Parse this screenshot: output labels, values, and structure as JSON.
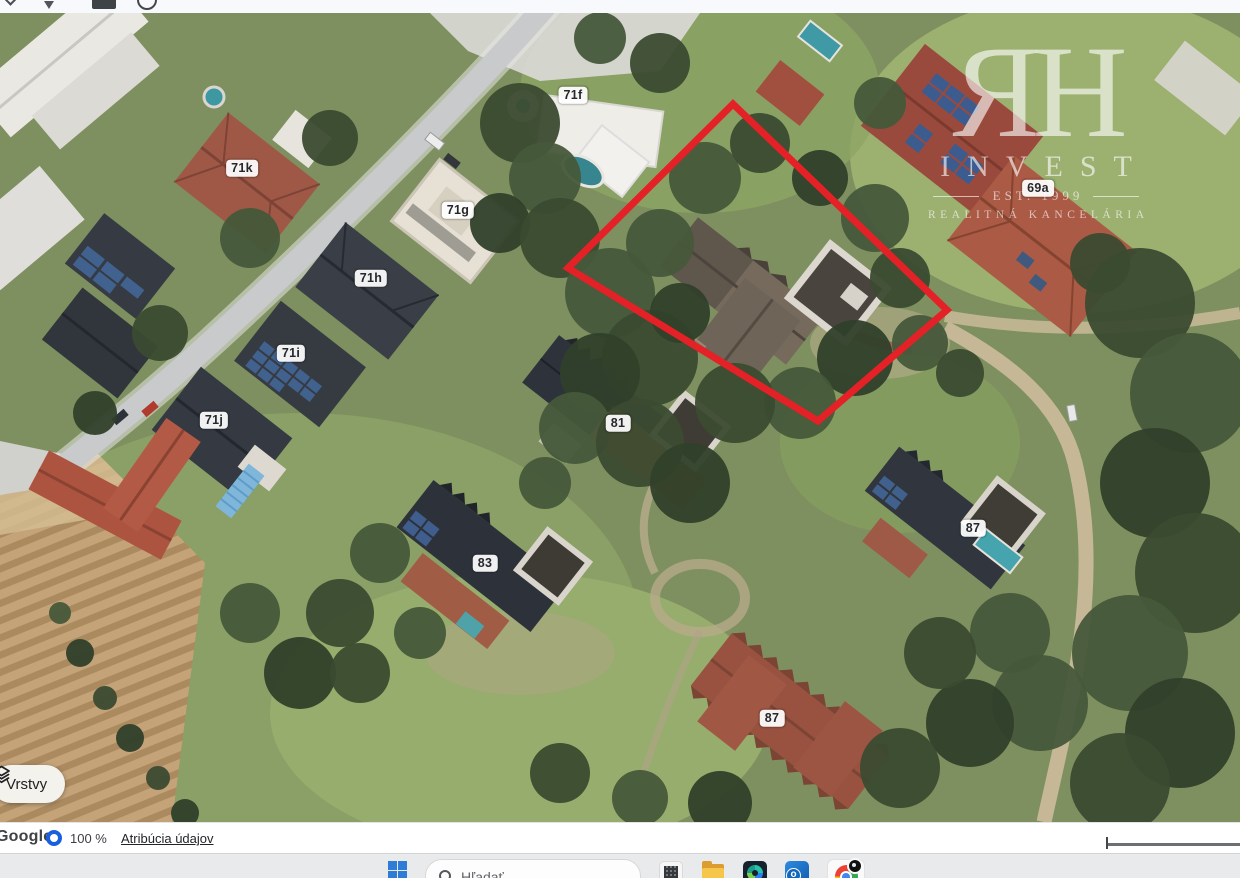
{
  "browser_strip": {
    "icons": [
      "chevron-down-icon",
      "pin-icon",
      "panel-icon",
      "clock-icon"
    ]
  },
  "map": {
    "type": "satellite-imagery",
    "house_labels": [
      {
        "text": "71f",
        "x": 573,
        "y": 82
      },
      {
        "text": "71k",
        "x": 242,
        "y": 155
      },
      {
        "text": "71g",
        "x": 458,
        "y": 197
      },
      {
        "text": "71h",
        "x": 371,
        "y": 265
      },
      {
        "text": "71i",
        "x": 291,
        "y": 340
      },
      {
        "text": "71j",
        "x": 214,
        "y": 407
      },
      {
        "text": "69a",
        "x": 1038,
        "y": 175
      },
      {
        "text": "81",
        "x": 618,
        "y": 410
      },
      {
        "text": "83",
        "x": 485,
        "y": 550
      },
      {
        "text": "87",
        "x": 973,
        "y": 515
      },
      {
        "text": "87",
        "x": 772,
        "y": 705
      }
    ],
    "selection_polygon": {
      "points": "733,91 568,255 818,408 947,297",
      "stroke": "#e42127",
      "stroke_width": "7"
    },
    "watermark": {
      "monogram": "ЯH",
      "name": "INVEST",
      "established": "EST. 1999",
      "subtitle": "REALITNÁ KANCELÁRIA"
    },
    "layers_button": {
      "label": "Vrstvy",
      "icon": "layers-icon"
    }
  },
  "status_bar": {
    "brand": "Google",
    "zoom_level": "100 %",
    "attribution_link": "Atribúcia údajov",
    "accent_blue": "#1a5fe0"
  },
  "taskbar": {
    "start_icon": "windows-start-icon",
    "search": {
      "placeholder": "Hľadať",
      "icon": "search-icon"
    },
    "apps": [
      {
        "name": "snipping-app-icon"
      },
      {
        "name": "file-explorer-icon"
      },
      {
        "name": "photos-app-icon"
      },
      {
        "name": "outlook-icon"
      },
      {
        "name": "chrome-icon",
        "active": true,
        "badge": true
      }
    ]
  }
}
